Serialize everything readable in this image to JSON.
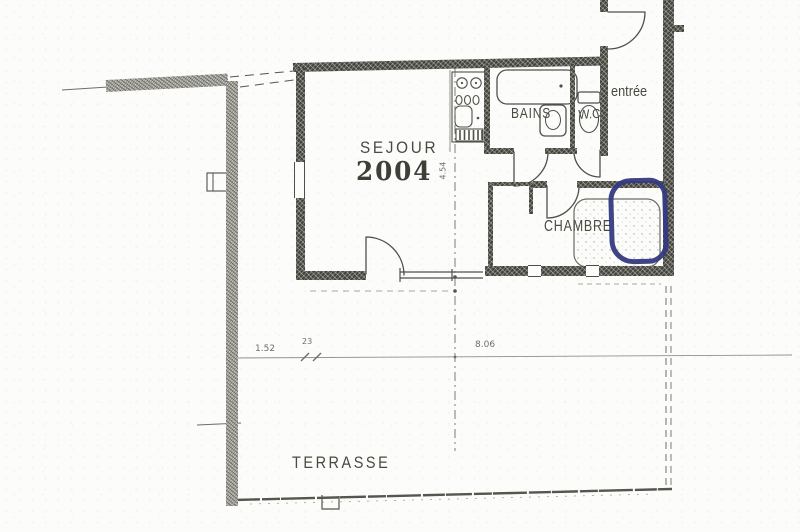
{
  "rooms": {
    "sejour": {
      "label": "SEJOUR",
      "number": "2004"
    },
    "bains": {
      "label": "BAINS"
    },
    "wc": {
      "label": "W.C"
    },
    "entree": {
      "label": "entrée"
    },
    "chambre": {
      "label": "CHAMBRE"
    },
    "terrasse": {
      "label": "TERRASSE"
    }
  },
  "dimensions": {
    "terrace_left_segment": "1.52",
    "terrace_small_segment": "23",
    "terrace_main_span": "8.06",
    "sejour_depth": "4.54"
  },
  "annotation": {
    "shape": "hand-drawn-ellipse",
    "color": "#343a80"
  },
  "colors": {
    "ink": "#50504a",
    "paper": "#fcfcfa",
    "boundary_wall": "#c6c6be"
  }
}
